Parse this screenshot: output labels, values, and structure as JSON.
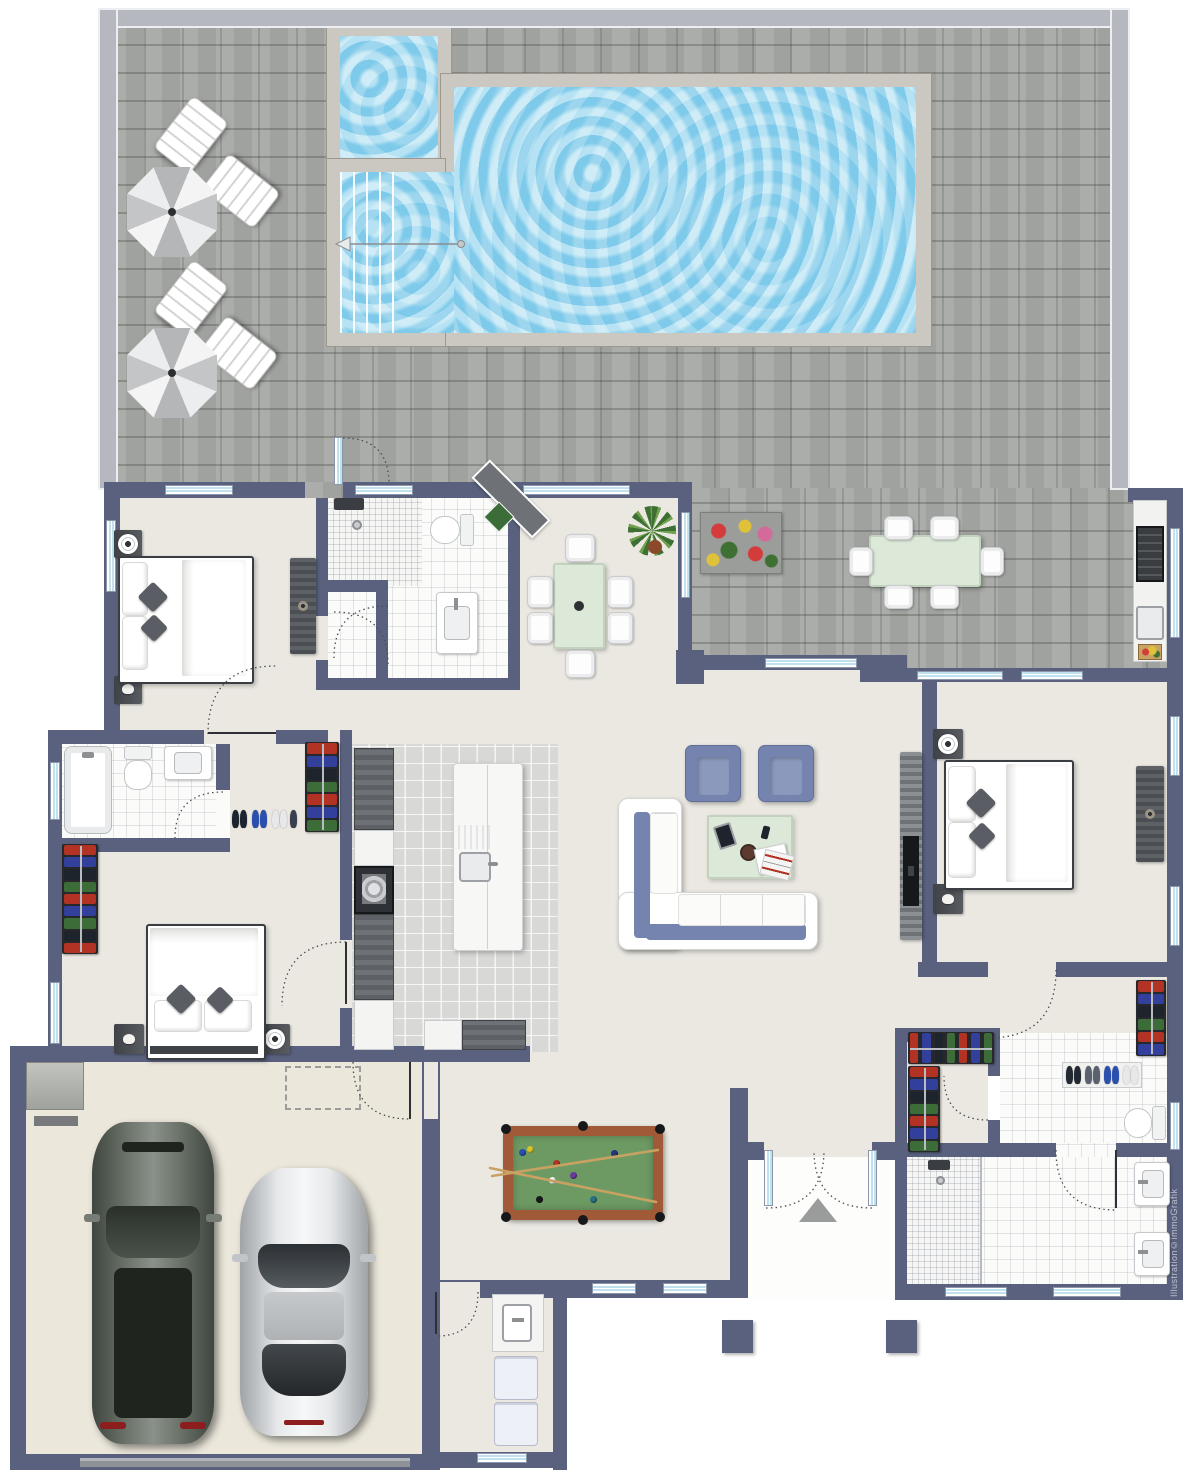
{
  "watermark": "Illustration©immoGrafik",
  "palette": {
    "wall": "#59617e",
    "fence": "#b5b8be",
    "paver": "#a7a9a5",
    "pool_water": "#8fd4ec",
    "pool_concrete": "#cbc8c1",
    "interior_floor": "#eae8e1",
    "bath_tile": "#fbfbfa",
    "kitchen_tile": "#d8d8d6",
    "garage_floor": "#ebe7db",
    "sofa_blue": "#7584ae",
    "table_green": "#dde9d8",
    "window_glass": "#bfe2ee"
  },
  "areas": [
    "pool-terrace",
    "main-pool",
    "kids-pool",
    "pool-steps",
    "bedroom-top-left",
    "bathroom-top-center",
    "dining-area",
    "kitchen",
    "hallway",
    "bathroom-left",
    "closet-left",
    "bedroom-bottom-left",
    "living-room",
    "master-bedroom",
    "walk-in-closet",
    "master-bathroom",
    "billiard-room",
    "entrance-hall",
    "entrance-porch",
    "laundry-room",
    "double-garage",
    "outdoor-kitchen",
    "outdoor-dining"
  ],
  "furniture": [
    "sun-umbrella x2",
    "sun-lounger x4",
    "double-bed x3",
    "wardrobe-rack x5",
    "l-sofa",
    "armchair x2",
    "coffee-table",
    "dining-table-6-chairs",
    "outdoor-table-6-chairs",
    "kitchen-island-with-sink",
    "oven",
    "grill",
    "billiard-table",
    "washer",
    "dryer",
    "suv-car",
    "sports-car",
    "toilet x3",
    "bathtub",
    "shower x3",
    "sink x6",
    "flower-planter",
    "potted-plant x2"
  ],
  "closet": {
    "colors": [
      "#b23223",
      "#32409c",
      "#1e242c",
      "#3c6c38",
      "#b23223",
      "#32409c",
      "#3c6c38",
      "#1e242c"
    ]
  },
  "pool_table": {
    "felt": "#6d9a63",
    "rim": "#a05a38",
    "cue_color": "#c9a263",
    "balls": [
      {
        "x": 36,
        "y": 41,
        "c": "#f4f4f4"
      },
      {
        "x": 6,
        "y": 13,
        "c": "#2b4fb0"
      },
      {
        "x": 14,
        "y": 10,
        "c": "#d9c32a"
      },
      {
        "x": 40,
        "y": 24,
        "c": "#b23223"
      },
      {
        "x": 57,
        "y": 36,
        "c": "#6b3b9c"
      },
      {
        "x": 98,
        "y": 14,
        "c": "#26337a"
      },
      {
        "x": 23,
        "y": 60,
        "c": "#17181a"
      },
      {
        "x": 77,
        "y": 60,
        "c": "#2a6f86"
      }
    ]
  },
  "entrance_marker": "triangle-up"
}
